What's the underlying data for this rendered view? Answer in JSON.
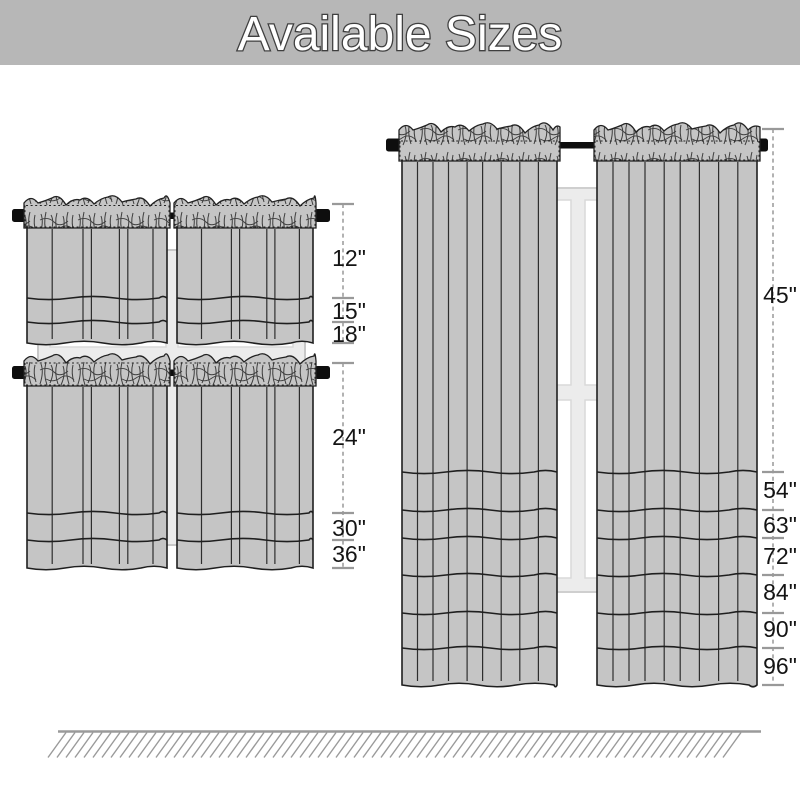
{
  "title": "Available Sizes",
  "measurements": {
    "small_tiers": {
      "labels": [
        "12\"",
        "15\"",
        "18\""
      ]
    },
    "large_tiers": {
      "labels": [
        "24\"",
        "30\"",
        "36\""
      ]
    },
    "long_panels": {
      "labels": [
        "45\"",
        "54\"",
        "63\"",
        "72\"",
        "84\"",
        "90\"",
        "96\""
      ]
    }
  },
  "colors": {
    "banner_bg": "#b7b7b7",
    "title_fill": "#ffffff",
    "title_outline": "#3f3f3f",
    "curtain_fill": "#c5c5c5",
    "curtain_outline": "#1f1f1f",
    "rod": "#0e0e0e",
    "window_frame": "#ececec",
    "window_pane": "#ffffff",
    "measure_line": "#999999",
    "label_text": "#141414",
    "floor": "#9a9a9a"
  }
}
